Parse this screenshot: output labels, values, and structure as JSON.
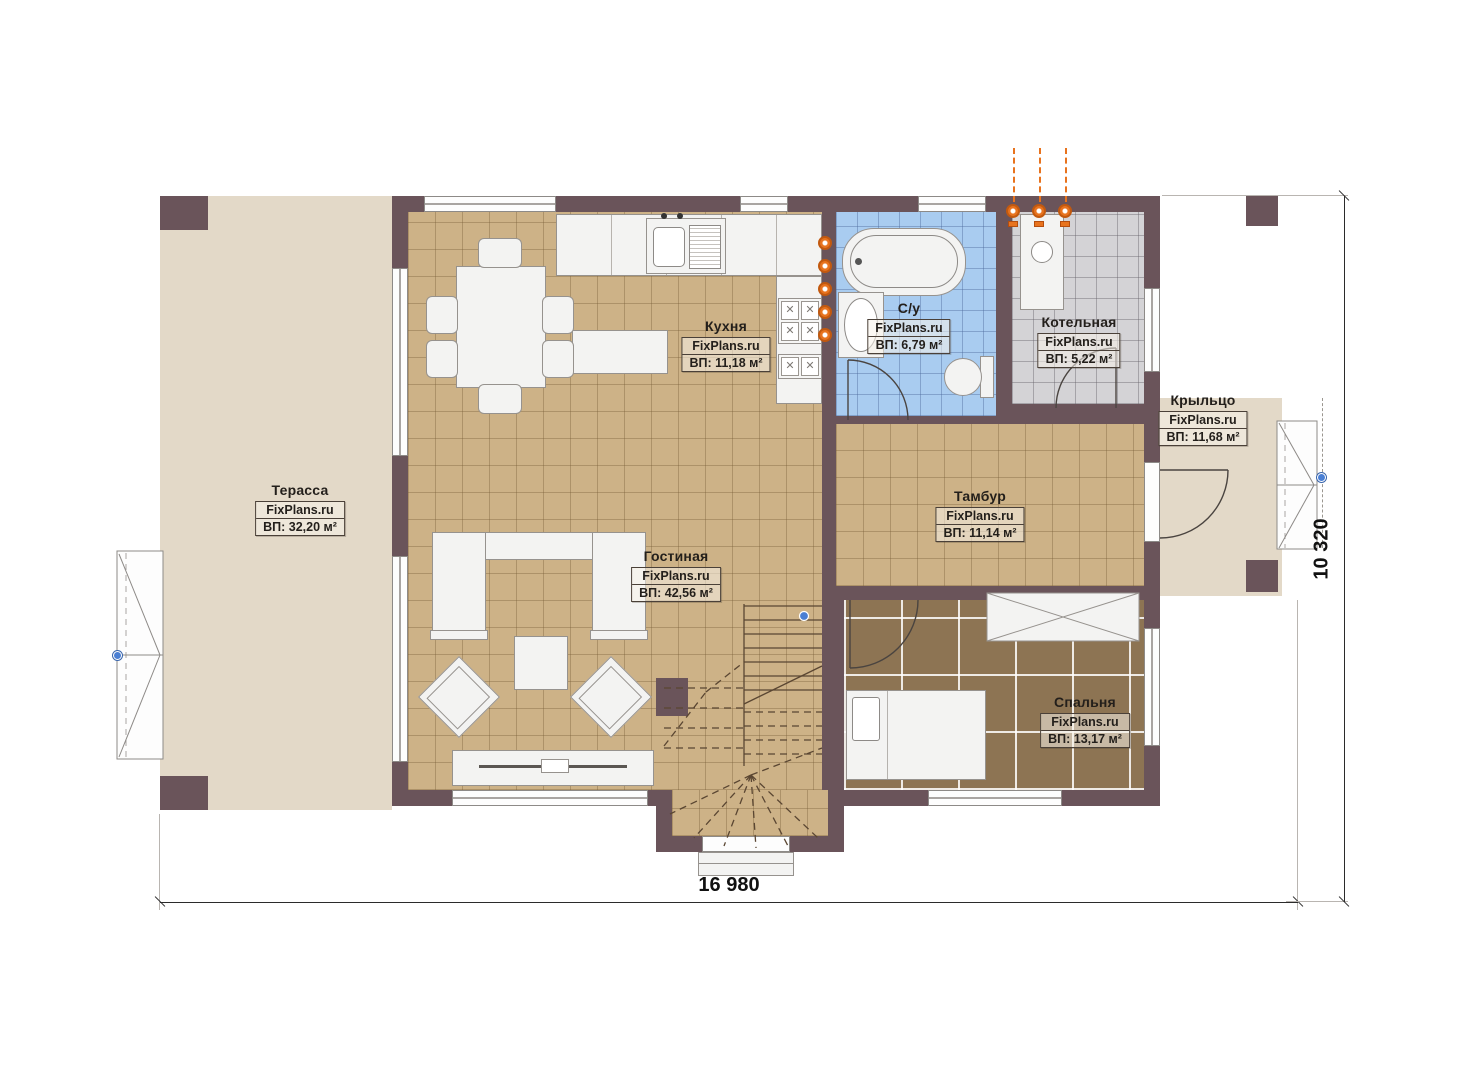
{
  "plan": {
    "title": "floor-plan",
    "rooms": [
      {
        "id": "terrace",
        "name": "Терасса",
        "watermark": "FixPlans.ru",
        "area": "ВП: 32,20 м²"
      },
      {
        "id": "kitchen",
        "name": "Кухня",
        "watermark": "FixPlans.ru",
        "area": "ВП: 11,18 м²"
      },
      {
        "id": "bathroom",
        "name": "С/у",
        "watermark": "FixPlans.ru",
        "area": "ВП: 6,79 м²"
      },
      {
        "id": "boiler",
        "name": "Котельная",
        "watermark": "FixPlans.ru",
        "area": "ВП: 5,22 м²"
      },
      {
        "id": "porch",
        "name": "Крыльцо",
        "watermark": "FixPlans.ru",
        "area": "ВП: 11,68 м²"
      },
      {
        "id": "tambour",
        "name": "Тамбур",
        "watermark": "FixPlans.ru",
        "area": "ВП: 11,14 м²"
      },
      {
        "id": "living",
        "name": "Гостиная",
        "watermark": "FixPlans.ru",
        "area": "ВП: 42,56 м²"
      },
      {
        "id": "bedroom",
        "name": "Спальня",
        "watermark": "FixPlans.ru",
        "area": "ВП: 13,17 м²"
      }
    ],
    "dimensions": {
      "width_label": "16 980",
      "height_label": "10 320"
    },
    "colors": {
      "wall": "#6a545a",
      "terrace_floor": "#e3d9c8",
      "tile_tan": "#cdb287",
      "tile_blue": "#a9ccf0",
      "tile_gray": "#d4d3d6",
      "bedroom_floor": "#8d7453",
      "heating_orange": "#e8731e",
      "marker_blue": "#4a7fd4"
    }
  }
}
